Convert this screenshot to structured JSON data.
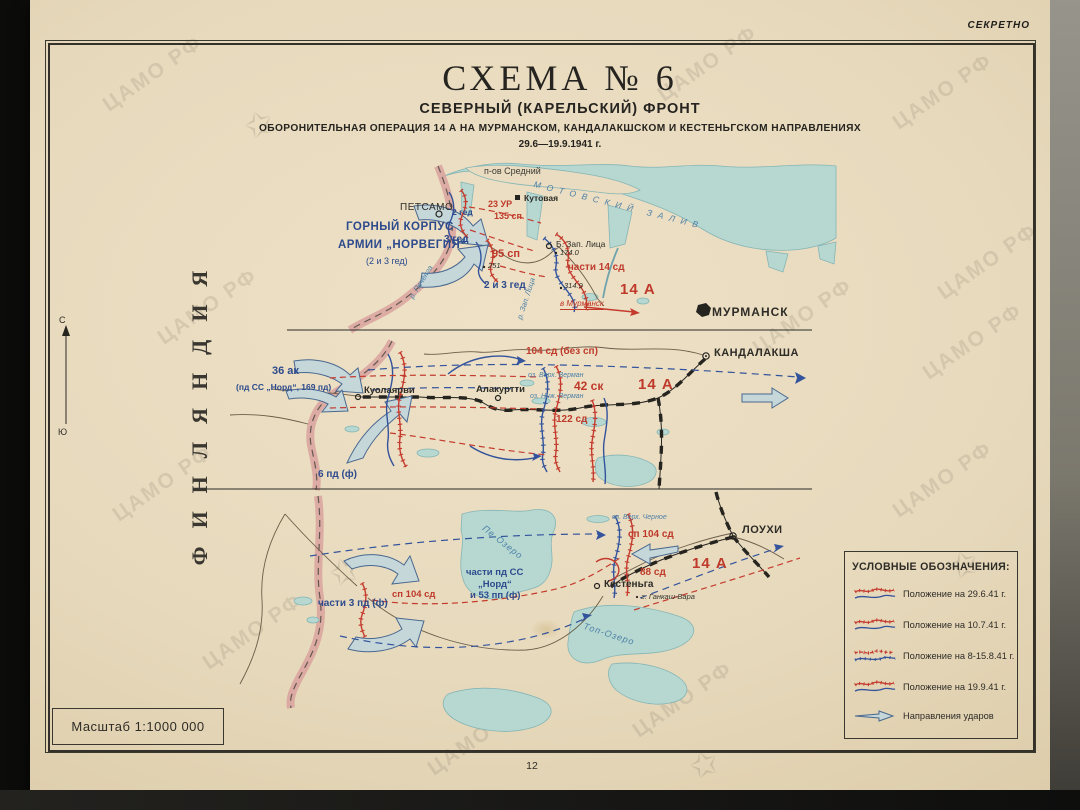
{
  "page": {
    "secret": "СЕКРЕТНО",
    "page_number": "12",
    "watermark": "ЦАМО РФ",
    "scale_label": "Масштаб 1:1000 000"
  },
  "title": {
    "schema": "СХЕМА № 6",
    "front": "СЕВЕРНЫЙ (КАРЕЛЬСКИЙ) ФРОНТ",
    "operation": "ОБОРОНИТЕЛЬНАЯ ОПЕРАЦИЯ 14 А НА МУРМАНСКОМ, КАНДАЛАКШСКОМ И КЕСТЕНЬГСКОМ НАПРАВЛЕНИЯХ",
    "dates": "29.6—19.9.1941 г."
  },
  "side": {
    "country": "ФИНЛЯНДИЯ",
    "north": "С",
    "south": "Ю"
  },
  "murmansk": {
    "peninsula": "п-ов Средний",
    "bay": "МОТОВСКИЙ ЗАЛИВ",
    "petsamo": "ПЕТСАМО",
    "kutovaya": "Кутовая",
    "ged2": "2 гед",
    "ur23": "23 УР",
    "sp135": "135 сп",
    "ged3": "3 гед",
    "corps_line1": "ГОРНЫЙ КОРПУС",
    "corps_line2": "АРМИИ „НОРВЕГИЯ“",
    "corps_line3": "(2 и 3 гед)",
    "sp95": "95 сп",
    "h251": "251",
    "zap_litsa_town": "Б. Зап. Лица",
    "h174": "174.0",
    "units14sd": "части 14 сд",
    "h314": "314.9",
    "ged23": "2 и 3 гед",
    "to_murmansk": "в Мурманск",
    "army": "14 А",
    "murmansk_city": "МУРМАНСК",
    "river_pechenga": "р. Печенга",
    "river_zap_litsa": "р. Зап. Лица"
  },
  "kandalaksha": {
    "sd104": "104 сд (без сп)",
    "city": "КАНДАЛАКША",
    "ak36": "36 ак",
    "ak36_sub": "(пд СС „Норд“, 169 пд)",
    "kuolajarvi": "Куолаярви",
    "alakurtti": "Алакуртти",
    "lake_verh": "оз. Верх. Верман",
    "sk42": "42 ск",
    "lake_nizh": "оз. Ниж. Верман",
    "army": "14 А",
    "sd122": "122 сд",
    "pd6": "6 пд (ф)"
  },
  "kestenga": {
    "lake_pe": "Пе-Озеро",
    "lake_chernoe": "оз. Верх. Черное",
    "sp104_east": "сп 104 сд",
    "louhi": "ЛОУХИ",
    "pd3": "части 3 пд (ф)",
    "sp104_west": "сп 104 сд",
    "ss_line1": "части пд СС",
    "ss_line2": "„Норд“",
    "ss_line3": "и 53 пп (ф)",
    "kestenga_town": "Кестеньга",
    "gankash": "г. Ганкаш-Вара",
    "sd88": "88 сд",
    "army": "14 А",
    "lake_top": "Топ-Озеро"
  },
  "legend": {
    "title": "УСЛОВНЫЕ ОБОЗНАЧЕНИЯ:",
    "items": [
      {
        "label": "Положение на 29.6.41 г."
      },
      {
        "label": "Положение на 10.7.41 г."
      },
      {
        "label": "Положение на 8-15.8.41 г."
      },
      {
        "label": "Положение на 19.9.41 г."
      },
      {
        "label": "Направления ударов"
      }
    ]
  },
  "colors": {
    "paper": "#e9dcc0",
    "water": "#b7d8d1",
    "border_band": "#d9a29e",
    "front_red": "#c43b2e",
    "front_blue": "#33539c"
  }
}
